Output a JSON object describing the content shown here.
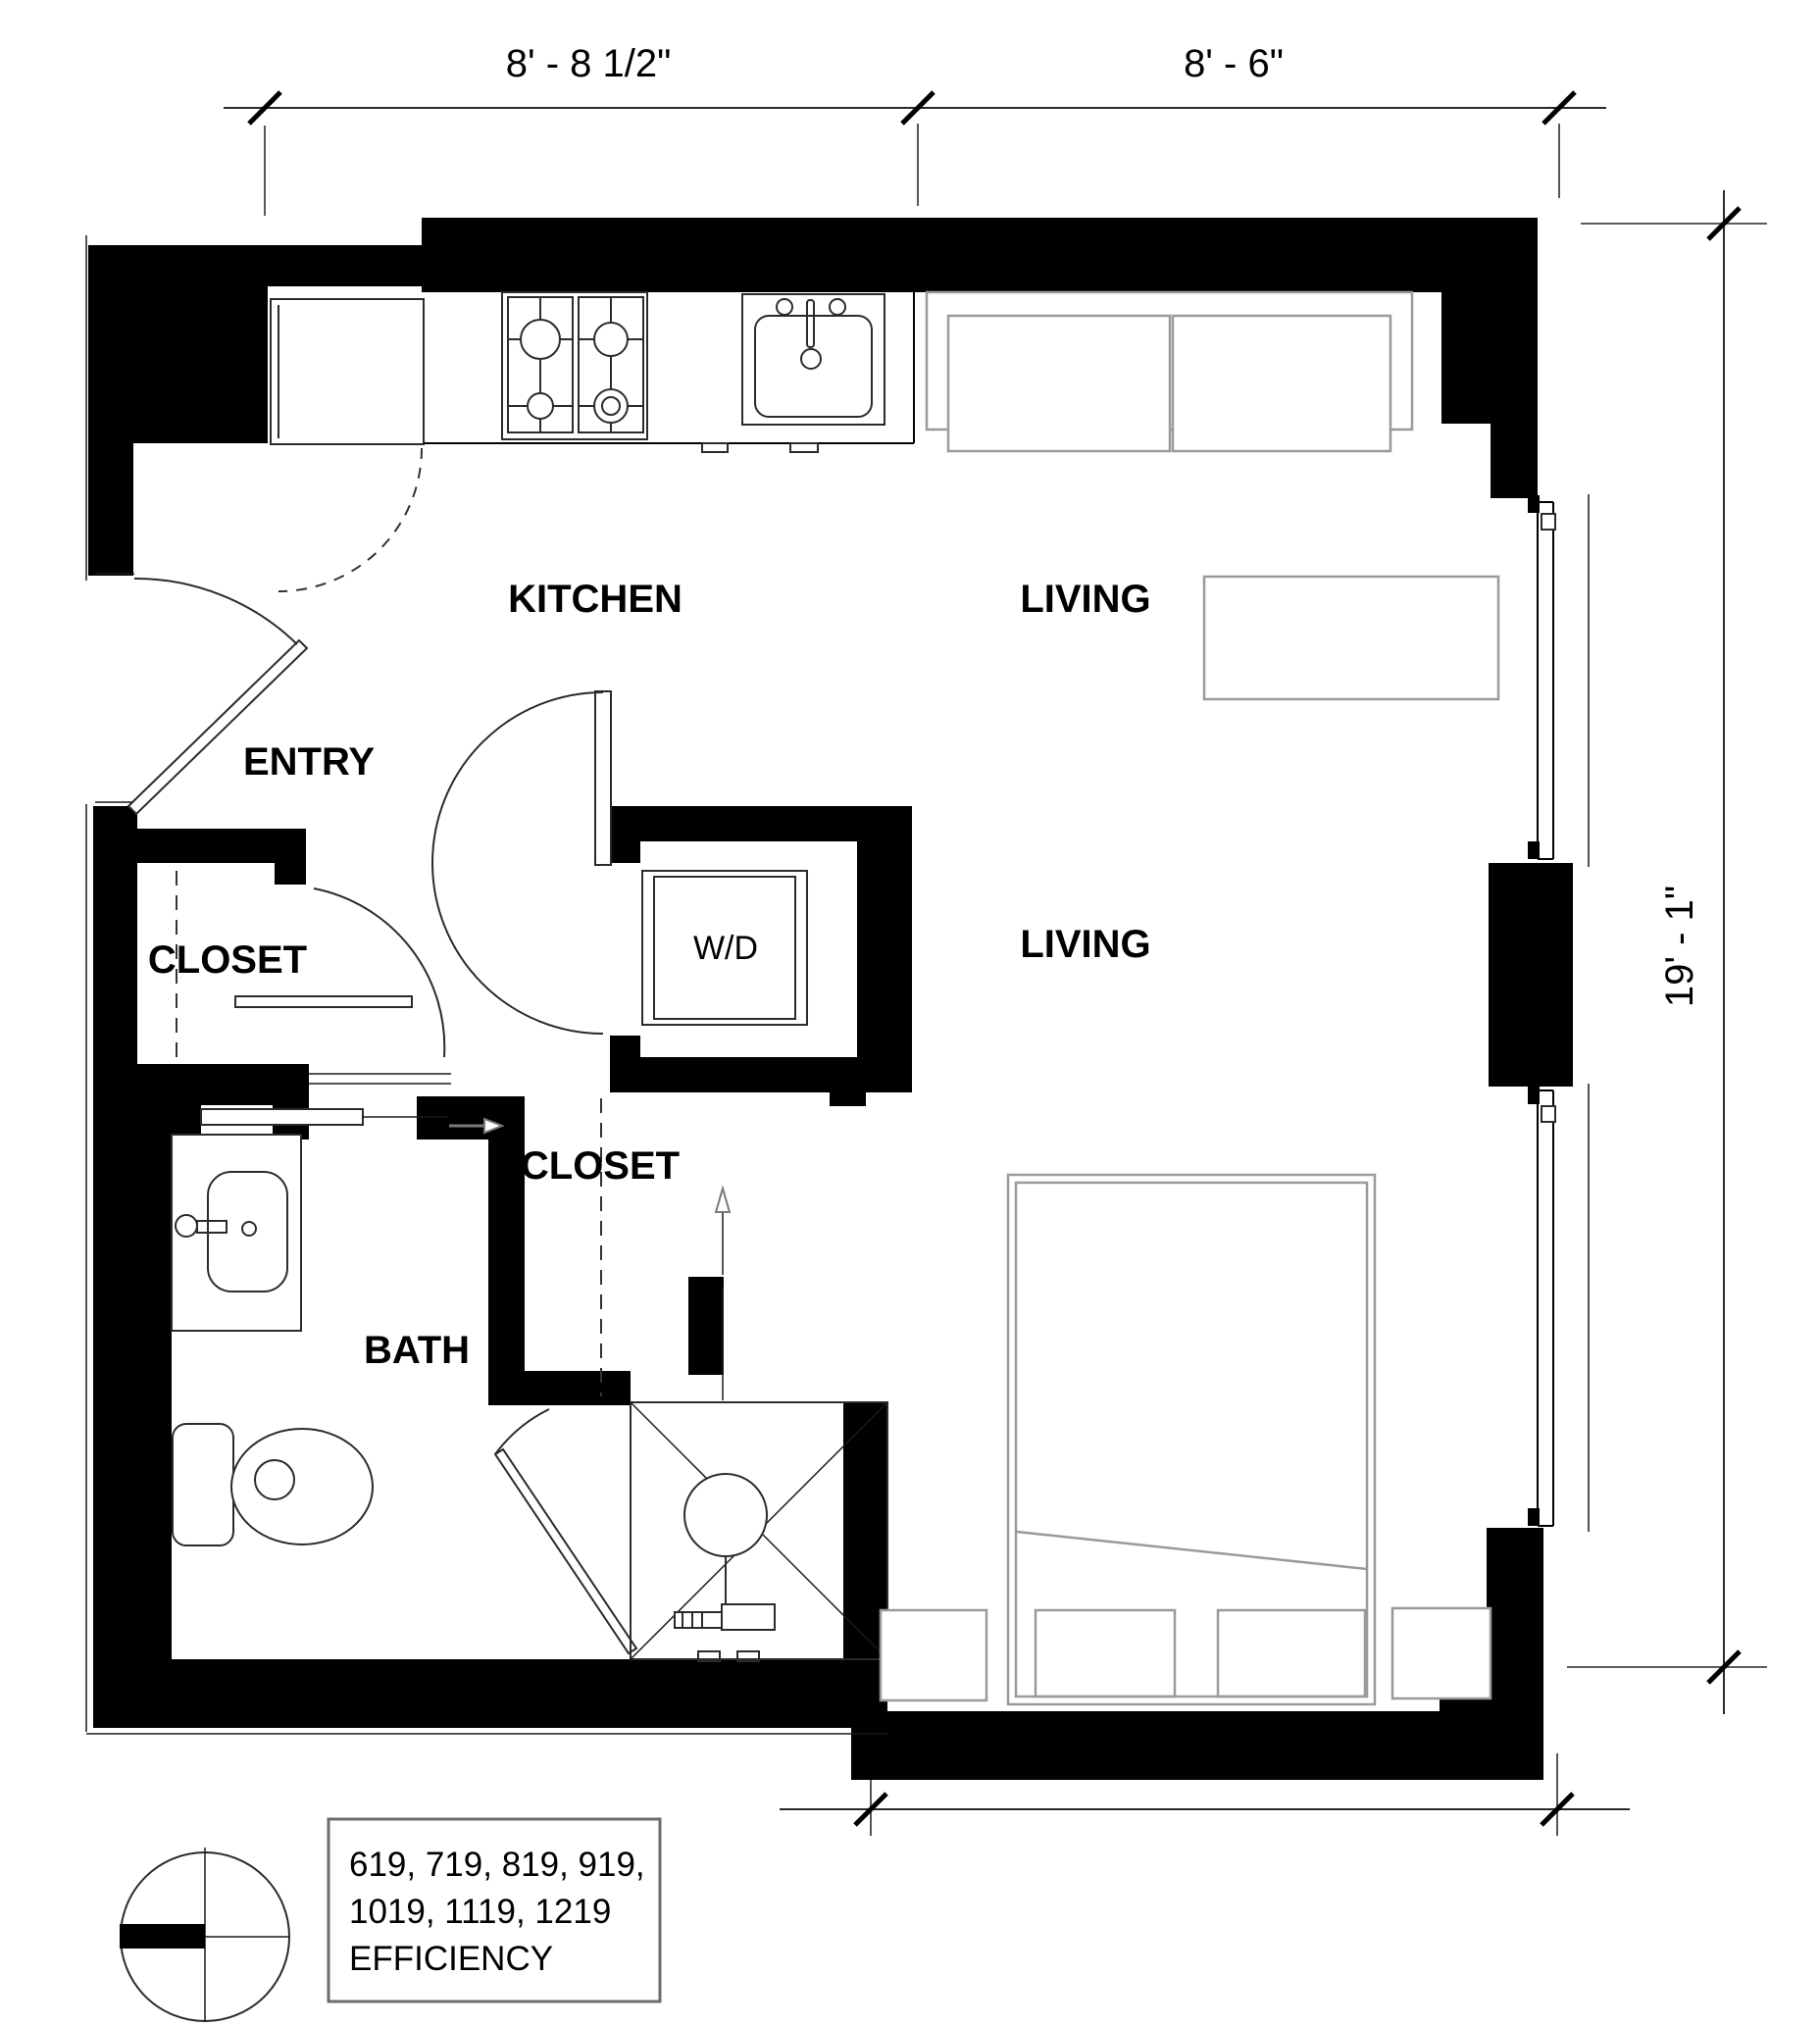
{
  "title": "Efficiency unit floor plan",
  "dimensions": {
    "top_left": "8' - 8 1/2\"",
    "top_right": "8' - 6\"",
    "right_side": "19' - 1\"",
    "bottom": "9' - 1 1/2\""
  },
  "rooms": {
    "kitchen": "KITCHEN",
    "living_upper": "LIVING",
    "entry": "ENTRY",
    "closet_entry": "CLOSET",
    "washer_dryer": "W/D",
    "closet_hall": "CLOSET",
    "bath": "BATH",
    "living_lower": "LIVING"
  },
  "unit_key": {
    "line1": "619, 719, 819, 919,",
    "line2": "1019, 1119, 1219",
    "line3": "EFFICIENCY"
  },
  "icons": [
    "refrigerator-icon",
    "stove-icon",
    "kitchen-sink-icon",
    "sofa-icon",
    "coffee-table-icon",
    "washer-dryer-icon",
    "bath-sink-icon",
    "toilet-icon",
    "shower-icon",
    "bed-icon",
    "nightstand-icon",
    "closet-rod-dashed",
    "door-swing-arc",
    "window-glazing",
    "direction-arrow",
    "keyplan-compass-icon"
  ],
  "colors": {
    "wall": "#000000",
    "furniture_line": "#9a9a9a",
    "fixture_line": "#2b2b2b",
    "background": "#ffffff"
  }
}
